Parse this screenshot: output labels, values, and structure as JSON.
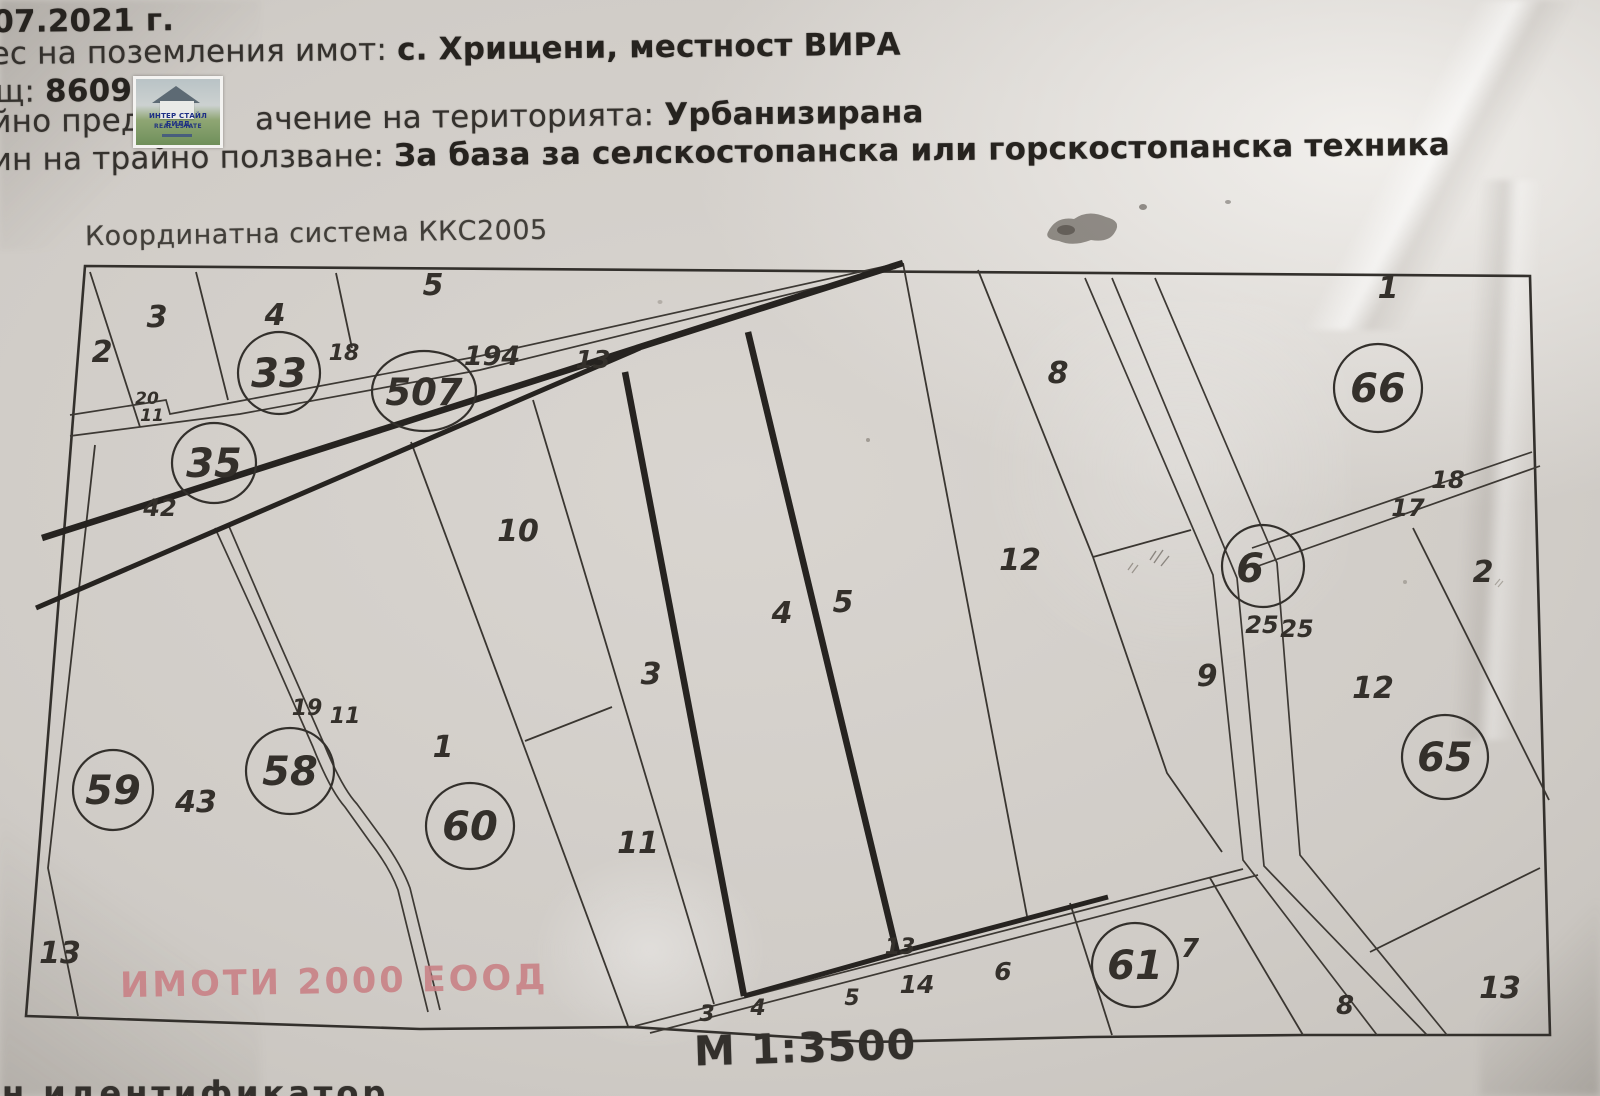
{
  "header": {
    "date_fragment": "07.2021 г.",
    "address_label": "ес на поземления имот:",
    "address_value": "с. Хрищени, местност ВИРА",
    "area_label": "щ:",
    "area_value": "8609",
    "purpose_label_before_logo": "йно предн",
    "purpose_label_after_logo": "ачение на територията:",
    "purpose_value": "Урбанизирана",
    "use_label": "ин на трайно ползване:",
    "use_value": "За база за селскостопанска или горскостопанска техника",
    "logo_line1": "ИНТЕР СТАЙЛ БИЛД",
    "logo_line2": "REAL ESTATE"
  },
  "map": {
    "coord_system": "Координатна система ККС2005",
    "scale": "М 1:3500",
    "watermark": "ИМОТИ 2000 ЕООД",
    "bottom_cut_text": "н идентификатор",
    "circled": {
      "c33": "33",
      "c507": "507",
      "c35": "35",
      "c66": "66",
      "c6": "6",
      "c59": "59",
      "c58": "58",
      "c60": "60",
      "c61": "61",
      "c65": "65"
    },
    "parcels": {
      "p2_tl": "2",
      "p3_tl": "3",
      "p4_tl": "4",
      "p5_tl": "5",
      "p10": "10",
      "p11": "11",
      "p1": "1",
      "p3": "3",
      "p4": "4",
      "p5": "5",
      "p12": "12",
      "p9": "9",
      "p8": "8",
      "p1_tr": "1",
      "p2_r": "2",
      "p12_r": "12",
      "p13_br": "13",
      "p8_br": "8",
      "p7": "7",
      "p13_bl": "13",
      "p43": "43"
    },
    "road_labels": {
      "r18_tl": "18",
      "r194": "194",
      "r13_tl": "13",
      "r42": "42",
      "r20": "20",
      "r11_tl": "11",
      "r19": "19",
      "r11_c": "11",
      "r18_r": "18",
      "r17_r": "17",
      "r25_a": "25",
      "r25_b": "25",
      "rb3": "3",
      "rb4": "4",
      "rb5": "5",
      "rb14": "14",
      "rb6": "6",
      "rb13": "13"
    }
  }
}
